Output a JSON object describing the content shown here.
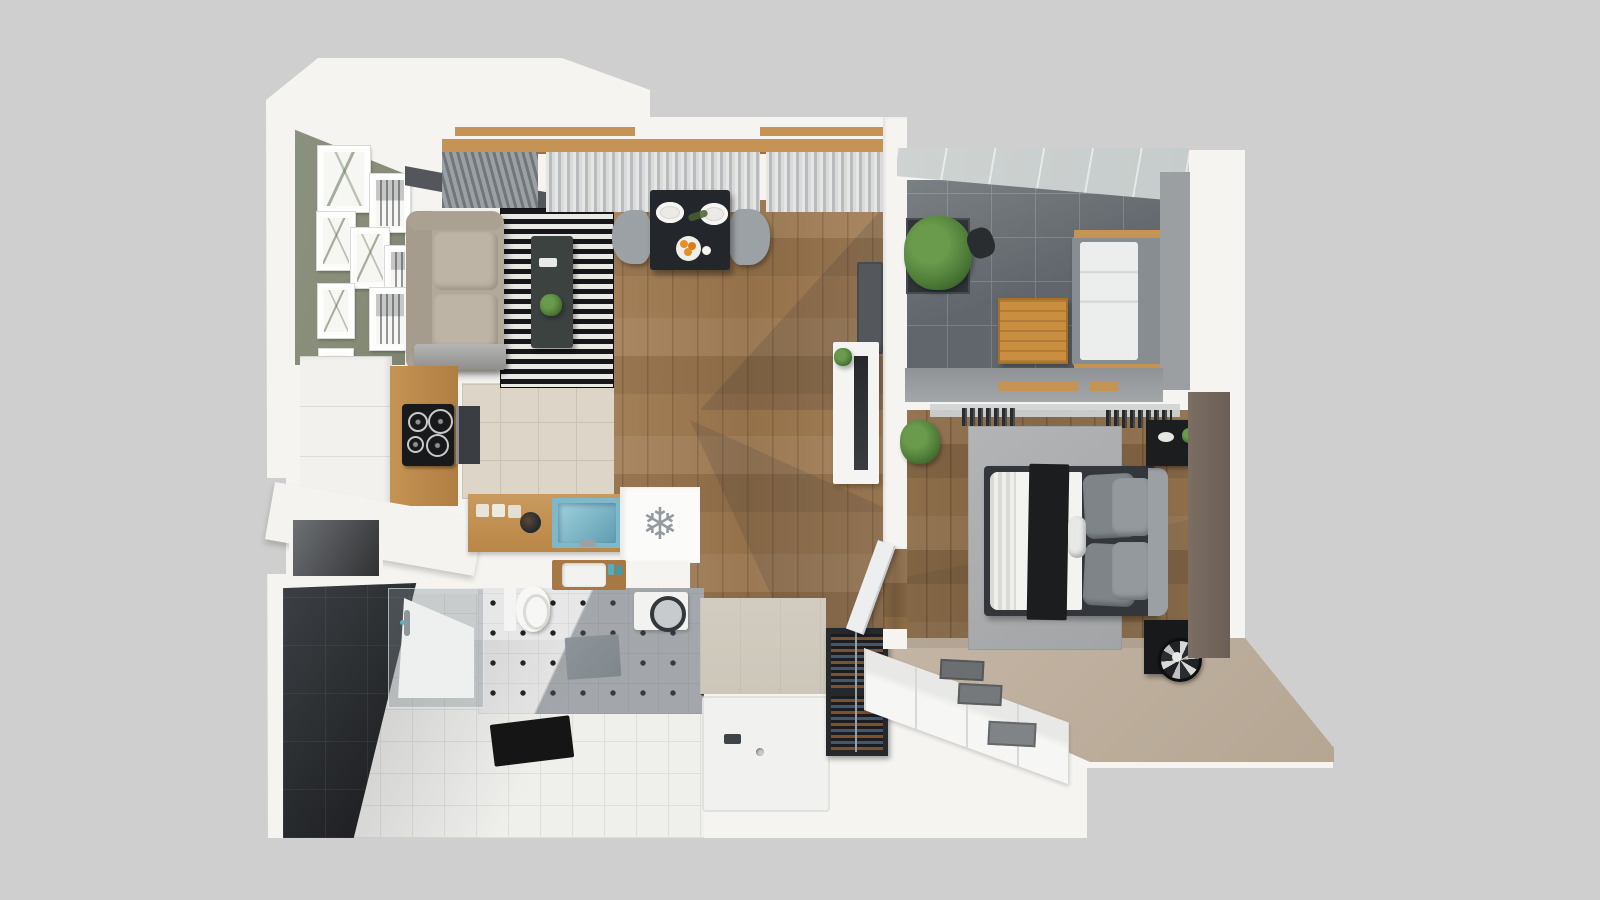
{
  "scene": {
    "type": "3d-floorplan-top-view-render",
    "rooms": [
      "living-room",
      "dining-area",
      "kitchen",
      "bathroom",
      "entry-hall",
      "shower-room",
      "balcony",
      "bedroom",
      "dressing-area"
    ]
  },
  "icons": {
    "freezer_snowflake": "❄"
  },
  "colors": {
    "bg": "#cfcfcf",
    "wall_white": "#f5f4f1",
    "wood_floor": "#a5815a",
    "wood_floor_dark": "#8f6f4a",
    "wood_accent": "#c59353",
    "wood_dark": "#a87844",
    "green_wall": "#878d77",
    "rug_black": "#17171b",
    "rug_white": "#e9e9e4",
    "sofa_beige": "#b2a999",
    "sofa_cushion": "#bdb4a5",
    "coffee_table": "#3c423f",
    "dining_table": "#23272c",
    "chair_gray": "#9ba1a4",
    "orange": "#e58f2a",
    "plant_green": "#4e7c38",
    "plant_green_light": "#6a9a4c",
    "balcony_tile": "#60666b",
    "balcony_grout": "#798085",
    "glass_roof": "#c6cccb",
    "gray_wall": "#9b9fa2",
    "taupe_wall": "#7b6e63",
    "bedroom_rug": "#abadaf",
    "bed_frame": "#33373b",
    "duvet_white": "#f3f3f1",
    "throw_black": "#1c1d1f",
    "pillow_gray": "#7e8488",
    "pillow_gray_light": "#93999d",
    "headboard_gray": "#9aa0a4",
    "black_unit": "#1b1d1f",
    "carpet_beige": "#c4b5a4",
    "closet_white": "#f6f6f4",
    "bin_gray": "#75797c",
    "kitchen_tile": "#ddd6c8",
    "kitchen_grout": "#cbc4b5",
    "cooktop_black": "#17191b",
    "oven_gray": "#3a3e42",
    "sink_teal": "#7db9ca",
    "sink_teal_dark": "#5f9db0",
    "fridge_white": "#fbfbfa",
    "icon_gray": "#949a9f",
    "octagon_tile": "#e7e7e7",
    "octagon_dot": "#202020",
    "entry_tile": "#efefec",
    "entry_grout": "#dededa",
    "dark_wall": "#2b2e31",
    "dark_wall_deep": "#17181a",
    "beige_wall": "#cdc7ba",
    "tray_white": "#f1f1ef",
    "mat_black": "#151515",
    "bath_mat": "#7f878d",
    "wine_frame": "#26292c",
    "bottle_brown": "#7a5230",
    "bottle_blue": "#45576c",
    "curtain_sheer": "#d9dbdb",
    "slat_dark": "#70767a",
    "track_dark": "#53575b"
  }
}
